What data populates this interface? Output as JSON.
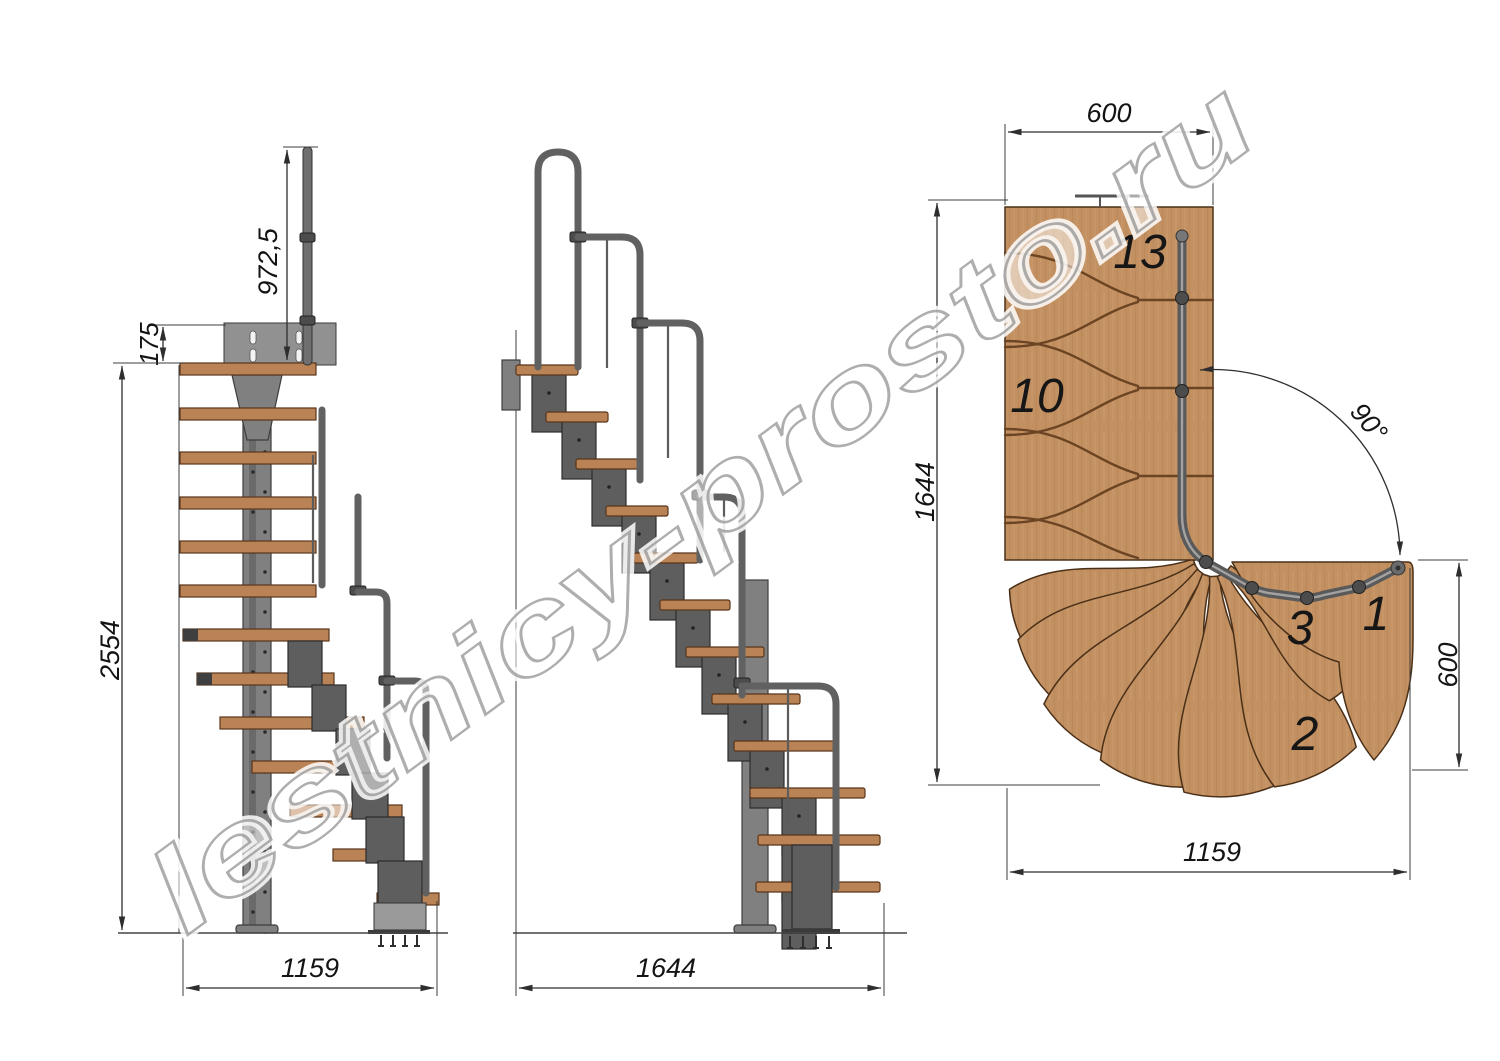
{
  "watermark": {
    "text": "lestnicy-prosto.ru"
  },
  "colors": {
    "wood_elevation": "#b98355",
    "wood_plan": "#c39062",
    "metal": "#808080",
    "dimension_lines": "#2e2e2e",
    "watermark_gray": "#9a9a9a"
  },
  "views": {
    "front_elevation": {
      "dimensions": {
        "handrail_height": "972,5",
        "mount_plate_height": "175",
        "total_height": "2554",
        "footprint_width": "1159"
      }
    },
    "side_elevation": {
      "dimensions": {
        "total_length": "1644"
      }
    },
    "plan": {
      "dimensions": {
        "flight_width_top": "600",
        "plan_depth": "1644",
        "turn_angle": "90°",
        "exit_width_right": "600",
        "plan_width_bottom": "1159"
      },
      "step_labels": {
        "s13": "13",
        "s10": "10",
        "s3": "3",
        "s1": "1",
        "s2": "2"
      }
    }
  }
}
